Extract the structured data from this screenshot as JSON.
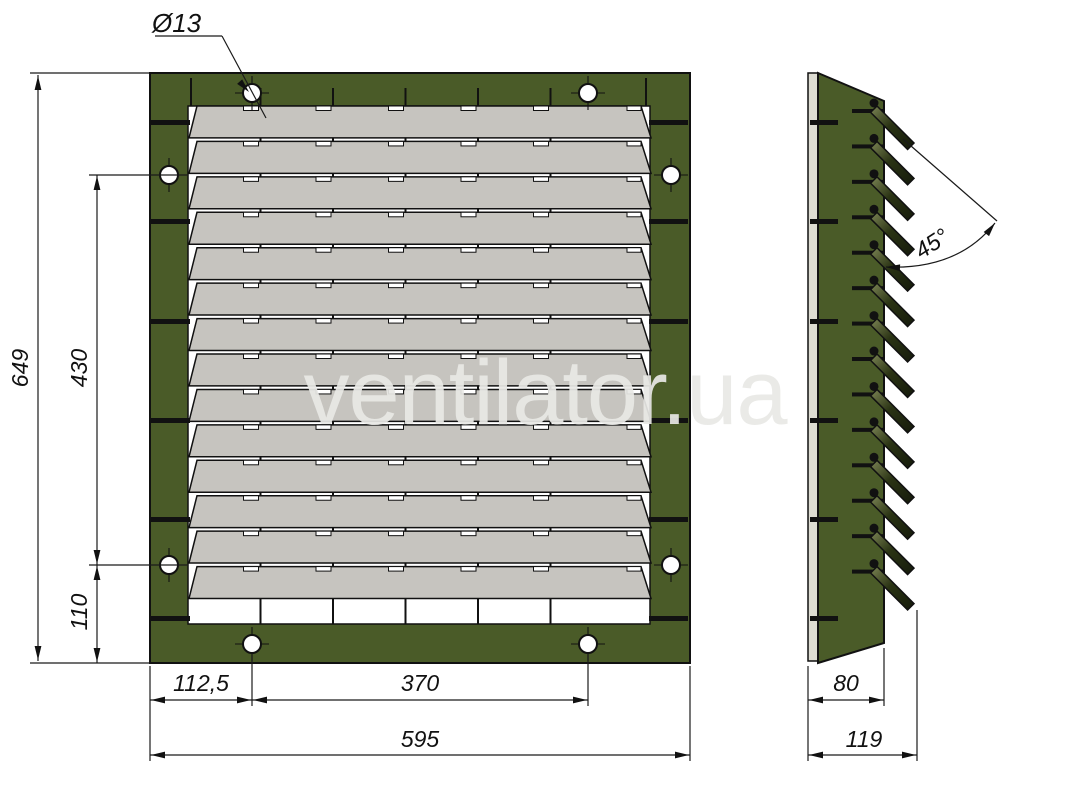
{
  "watermark": {
    "text": "ventilator.ua",
    "color": "#e9e9e6"
  },
  "drawing": {
    "type": "technical-drawing",
    "subject": "ventilation louver grille, front and side views",
    "front_view": {
      "slat_count": 14,
      "mullion_count": 5,
      "mounting_hole_count": 8,
      "hole_label": "Ø13",
      "dims": {
        "height": "649",
        "hole_span_vertical": "430",
        "hole_bottom_offset": "110",
        "hole_left_offset": "112,5",
        "hole_span_horizontal": "370",
        "width": "595"
      }
    },
    "side_view": {
      "slat_count": 14,
      "dims": {
        "blade_angle": "45°",
        "frame_depth": "80",
        "total_depth": "119"
      }
    },
    "colors": {
      "frame_green": "#4a5b28",
      "slat_gray": "#c6c4bf",
      "louver_dark": "#2a3314",
      "line": "#1a1a1a"
    }
  }
}
